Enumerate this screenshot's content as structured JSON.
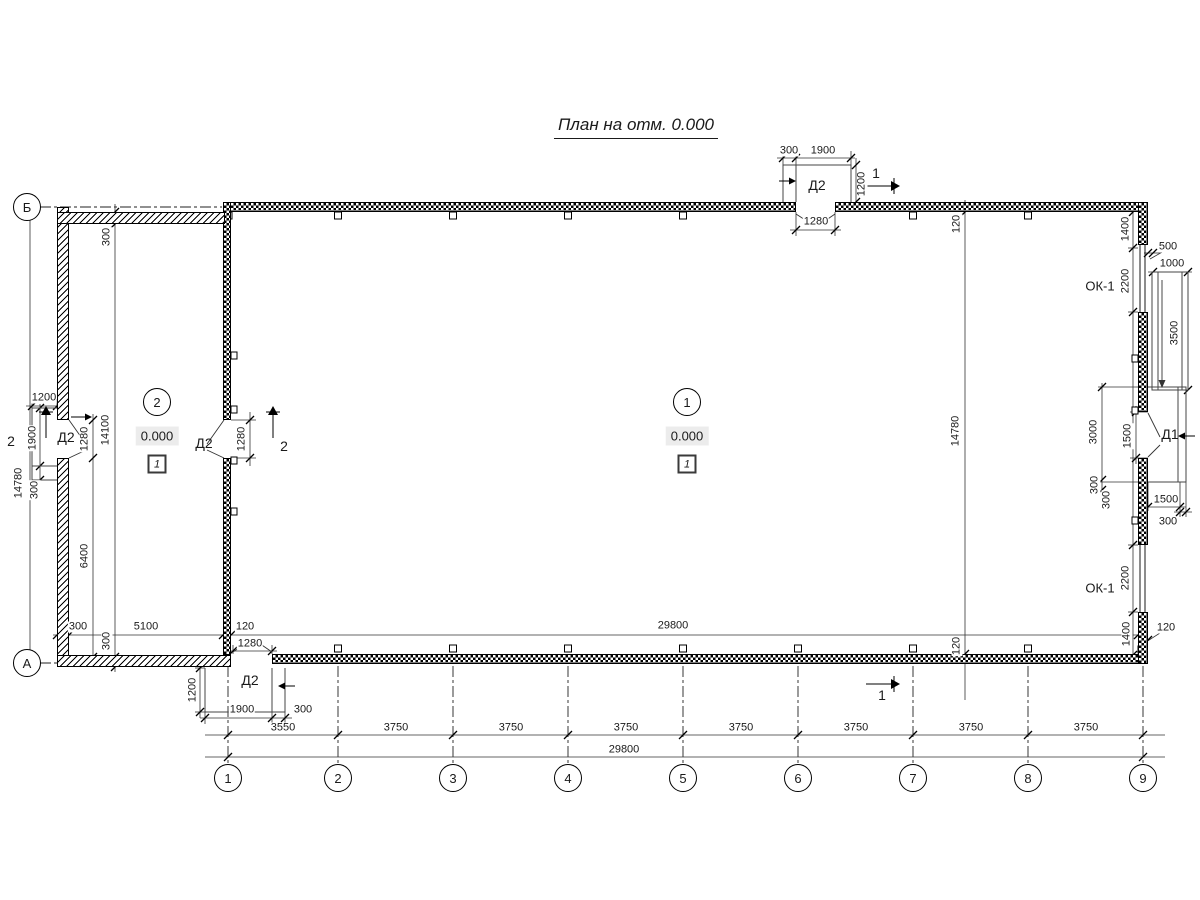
{
  "title": "План на отм. 0.000",
  "axes": {
    "cols": [
      "1",
      "2",
      "3",
      "4",
      "5",
      "6",
      "7",
      "8",
      "9"
    ],
    "rows": {
      "top": "Б",
      "bottom": "А"
    }
  },
  "rooms": {
    "hall": {
      "num": "1",
      "elev": "0.000",
      "floor": "1"
    },
    "annex": {
      "num": "2",
      "elev": "0.000",
      "floor": "1"
    }
  },
  "labels": {
    "door_d1": "Д1",
    "door_d2": "Д2",
    "window_ok1": "ОК-1",
    "section_1": "1",
    "section_2": "2"
  },
  "dims": {
    "top_door": {
      "offset": "300",
      "width": "1900",
      "depth": "1200",
      "opening": "1280"
    },
    "bottom_door": {
      "opening": "1280",
      "depth": "1200",
      "width": "1900",
      "offset": "300"
    },
    "left_door": {
      "depth": "1200",
      "width": "1900",
      "offset": "300",
      "opening": "1280"
    },
    "partition_door": {
      "opening": "1280"
    },
    "annex": {
      "wall_top": "300",
      "inner_height": "14100",
      "below_door": "6400",
      "wall_left": "300",
      "inner_width": "5100",
      "partition": "120",
      "wall_bottom": "300"
    },
    "overall": {
      "height_left": "14780",
      "height_inner": "14780",
      "panel_top": "120",
      "panel_bottom": "120",
      "inner_width": "29800",
      "total_width": "29800"
    },
    "right": {
      "corner_to_window": "1400",
      "window_height": "2200",
      "ramp_offset": "500",
      "ramp_width": "1000",
      "ramp_length": "3500",
      "porch_height": "3000",
      "door_opening": "1500",
      "offset_a": "300",
      "offset_b": "300",
      "porch_width": "1500",
      "porch_offset": "300",
      "window2_height": "2200",
      "window2_to_corner": "1400",
      "wall_panel": "120"
    },
    "bays": [
      "3550",
      "3750",
      "3750",
      "3750",
      "3750",
      "3750",
      "3750",
      "3750"
    ]
  }
}
